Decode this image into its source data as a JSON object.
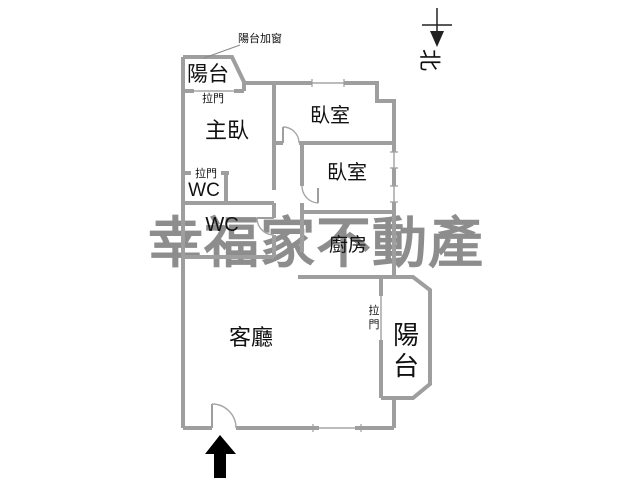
{
  "page": {
    "type": "apartment-floor-plan",
    "background": "#ffffff"
  },
  "watermark": {
    "text": "幸福家不動產",
    "color": "#8d8d8d"
  },
  "north": {
    "label": "北"
  },
  "annotations": {
    "balcony_added_window": "陽台加窗"
  },
  "rooms": {
    "balcony_top_left": "陽台",
    "master_bedroom": "主臥",
    "bedroom_upper": "臥室",
    "bedroom_lower": "臥室",
    "wc_upper": "WC",
    "wc_lower": "WC",
    "kitchen": "廚房",
    "living_room": "客廳",
    "balcony_right": {
      "char1": "陽",
      "char2": "台"
    }
  },
  "doors": {
    "balcony_top_sliding": "拉門",
    "wc_upper_sliding": "拉門",
    "balcony_right_sliding": {
      "char1": "拉",
      "char2": "門"
    }
  },
  "colors": {
    "wall": "#9e9e9e",
    "label_text": "#111111",
    "watermark": "#8d8d8d",
    "entrance_arrow": "#000000",
    "north_symbol": "#222222",
    "background": "#ffffff"
  }
}
